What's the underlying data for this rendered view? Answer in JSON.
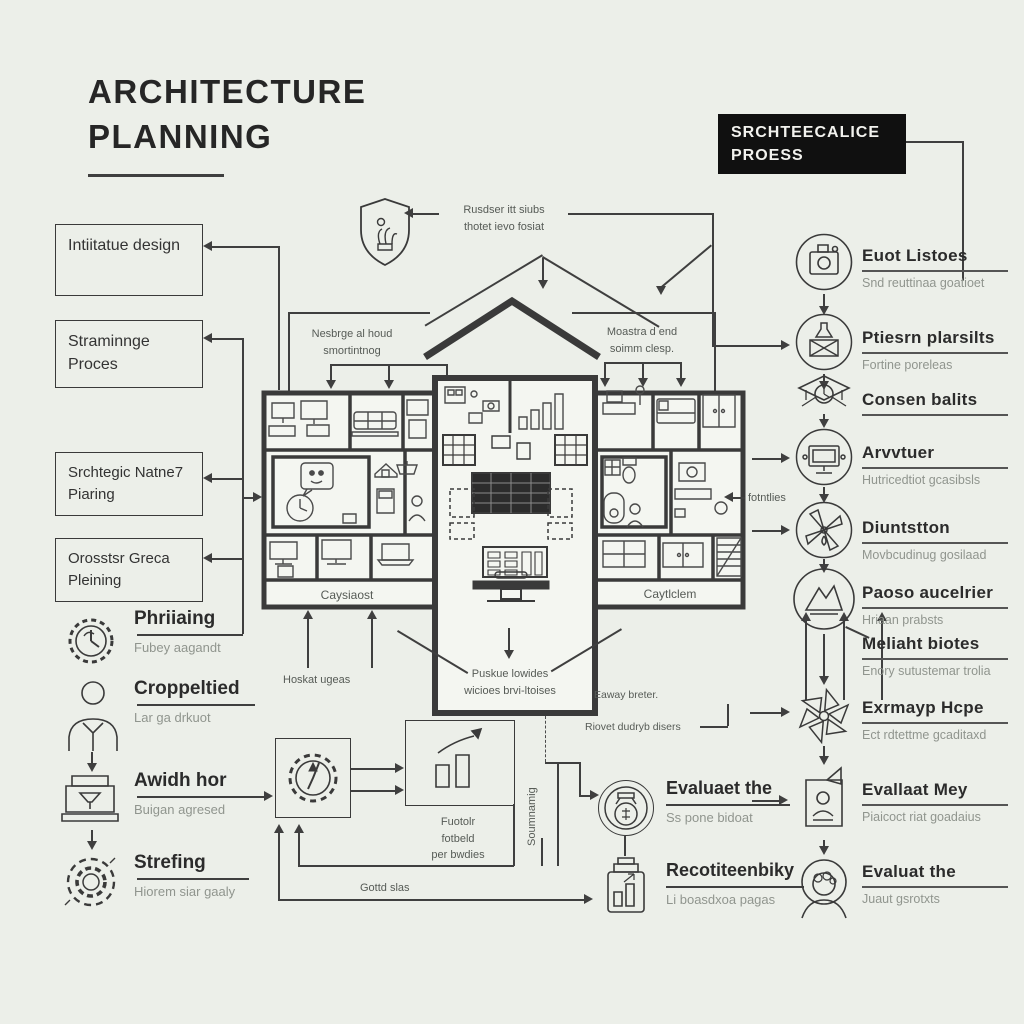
{
  "title": {
    "line1": "ARCHITECTURE",
    "line2": "PLANNING"
  },
  "header_box": {
    "line1": "SRCHTEECALICE",
    "line2": "PROESS"
  },
  "left_boxes": [
    {
      "label": "Intiitatue design"
    },
    {
      "label": "Straminnge Proces"
    },
    {
      "label": "Srchtegic Natne7 Piaring"
    },
    {
      "label": "Orosstsr Greca Pleining"
    }
  ],
  "left_items": [
    {
      "icon": "gear-clock-icon",
      "label": "Phriiaing",
      "sub": "Fubey aagandt"
    },
    {
      "icon": "person-icon",
      "label": "Croppeltied",
      "sub": "Lar ga drkuot"
    },
    {
      "icon": "machine-icon",
      "label": "Awidh hor",
      "sub": "Buigan agresed"
    },
    {
      "icon": "gear-badge-icon",
      "label": "Strefing",
      "sub": "Hiorem siar gaaly"
    }
  ],
  "right_items": [
    {
      "icon": "camera-circle-icon",
      "label": "Euot Listoes",
      "sub": "Snd reuttinaa goatioet"
    },
    {
      "icon": "flask-circle-icon",
      "label": "Ptiesrn plarsilts",
      "sub": "Fortine poreleas"
    },
    {
      "icon": "grad-cap-icon",
      "label": "Consen balits",
      "sub": ""
    },
    {
      "icon": "monitor-circle-icon",
      "label": "Arvvtuer",
      "sub": "Hutricedtiot gcasibsls"
    },
    {
      "icon": "windmill-circle-icon",
      "label": "Diuntstton",
      "sub": "Movbcudinug gosilaad"
    },
    {
      "icon": "mountain-circle-icon",
      "label": "Paoso aucelrier",
      "sub": "Hriaan prabsts"
    },
    {
      "icon": "",
      "label": "Meliaht biotes",
      "sub": "Enory sutustemar trolia"
    },
    {
      "icon": "pinwheel-icon",
      "label": "Exrmayp Hcpe",
      "sub": "Ect rdtettme gcaditaxd"
    },
    {
      "icon": "certificate-icon",
      "label": "Evallaat Mey",
      "sub": "Piaicoct riat goadaius"
    },
    {
      "icon": "person-halo-icon",
      "label": "Evaluat the",
      "sub": "Juaut gsrotxts"
    }
  ],
  "center_labels": {
    "shield_note_line1": "Rusdser itt siubs",
    "shield_note_line2": "thotet ievo fosiat",
    "left_roof_line1": "Nesbrge al houd",
    "left_roof_line2": "smortintnog",
    "right_roof_line1": "Moastra d end",
    "right_roof_line2": "soimm clesp.",
    "left_footer": "Caysiaost",
    "right_footer": "Caytlclem",
    "fotntles": "fotntlies",
    "hoskat": "Hoskat ugeas",
    "bottom_line1": "Puskue lowides",
    "bottom_line2": "wicioes brvi-ltoises",
    "eaway": "Eaway breter.",
    "riovet": "Riovet dudryb disers",
    "soumnamig": "Soumnamig"
  },
  "flowchart": {
    "note_line1": "Fuotolr",
    "note_line2": "fotbeld",
    "note_line3": "per bwdies",
    "gottd": "Gottd slas",
    "evaluate": {
      "label": "Evaluaet the",
      "sub": "Ss pone bidoat"
    },
    "recot": {
      "label": "Recotiteenbiky",
      "sub": "Li boasdxoa pagas"
    }
  },
  "colors": {
    "background": "#ecefe9",
    "ink": "#2f2f2f",
    "muted": "#90958e",
    "dark_box_bg": "#101010",
    "dark_box_text": "#f2f2ee",
    "wall": "#3a3a3a",
    "line": "#3f3f3f"
  }
}
